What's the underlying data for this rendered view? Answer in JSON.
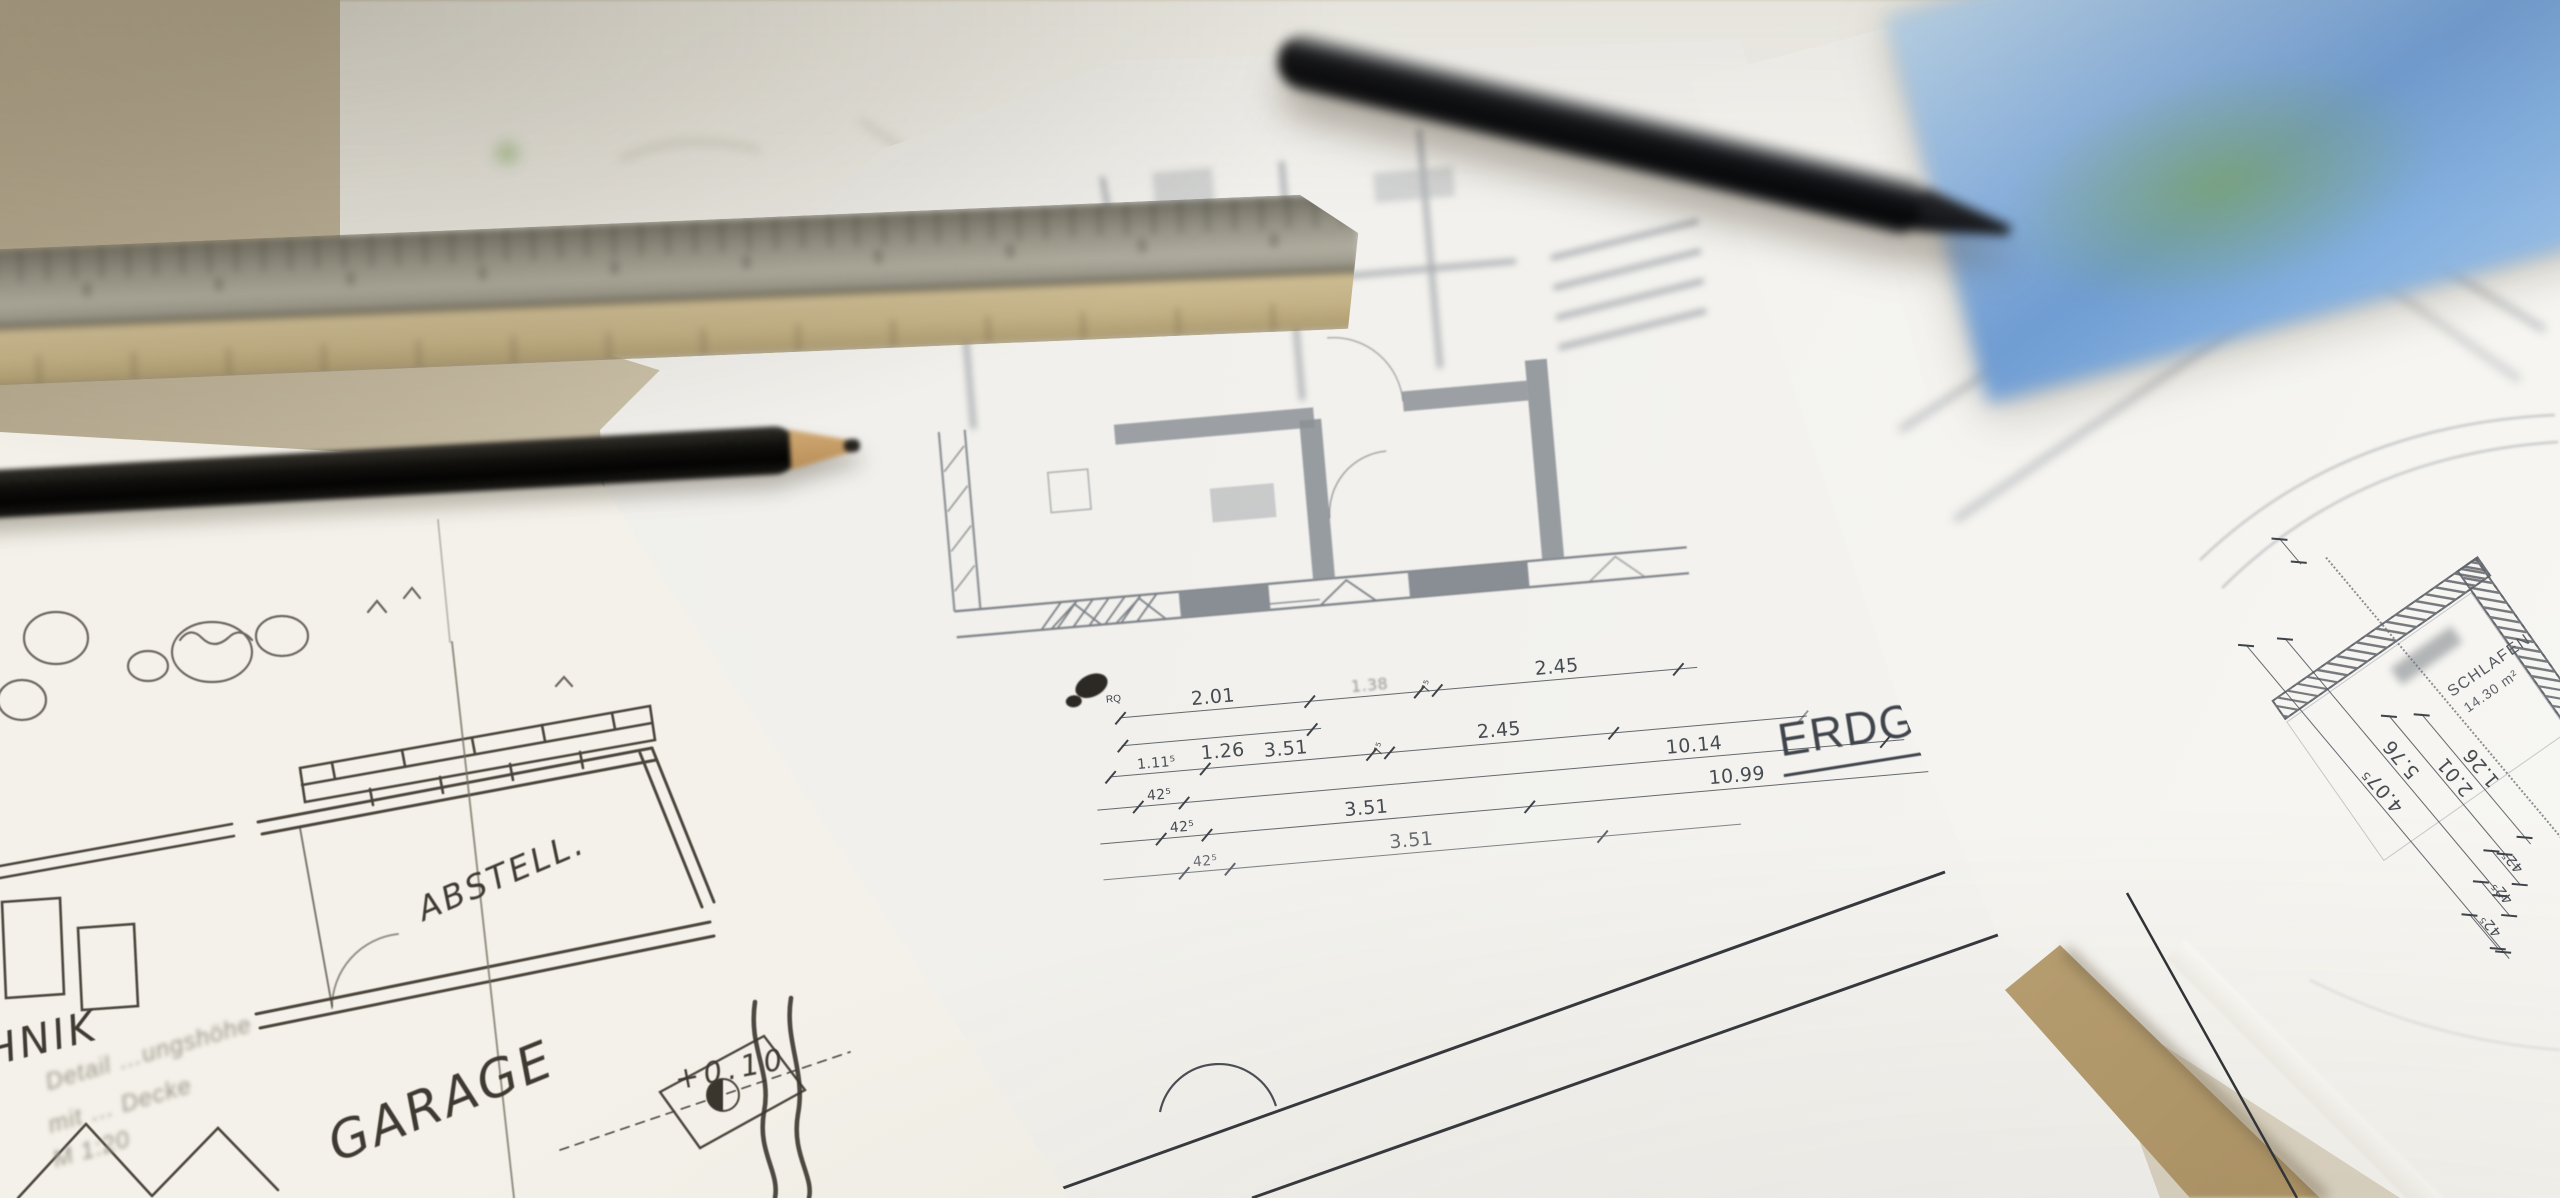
{
  "sketch_sheet": {
    "room_label_1": "ABSTELL.",
    "room_label_2": "GARAGE",
    "level_mark": "+0.10",
    "edge_label_partial": "HNIK",
    "print_notes": [
      "Detail …ungshöhe",
      "mit … Decke",
      "M 1:20"
    ]
  },
  "center_plan": {
    "title_partial": "ERDG",
    "section_mark": "RQ",
    "rows": [
      [
        "2.01",
        "1.38",
        "7⁵",
        "2.45"
      ],
      [
        "1.26"
      ],
      [
        "1.11⁵",
        "3.51",
        "7⁵",
        "2.45"
      ],
      [
        "42⁵",
        "10.14"
      ],
      [
        "42⁵",
        "3.51",
        "10.99"
      ],
      [
        "42⁵",
        "3.51"
      ]
    ]
  },
  "right_plan": {
    "room": "SCHLAFEN",
    "room_area": "14.30 m²",
    "rows": [
      [
        "1.26"
      ],
      [
        "2.01"
      ],
      [
        "5.76"
      ],
      [
        "4.07⁵"
      ],
      [
        "42⁵",
        "42⁵",
        "42⁵"
      ]
    ]
  },
  "colors": {
    "desk": "#cdc2ab",
    "paper": "#f1efe8",
    "plan_line": "#565b61",
    "ink": "#3f3a31",
    "tree_green": "#7fae5e",
    "photo_blue": "#7fa8d9",
    "ruler_metal": "#97948a",
    "ruler_wood": "#c9b88f",
    "pencil": "#17150f",
    "pen": "#0e0f12"
  }
}
